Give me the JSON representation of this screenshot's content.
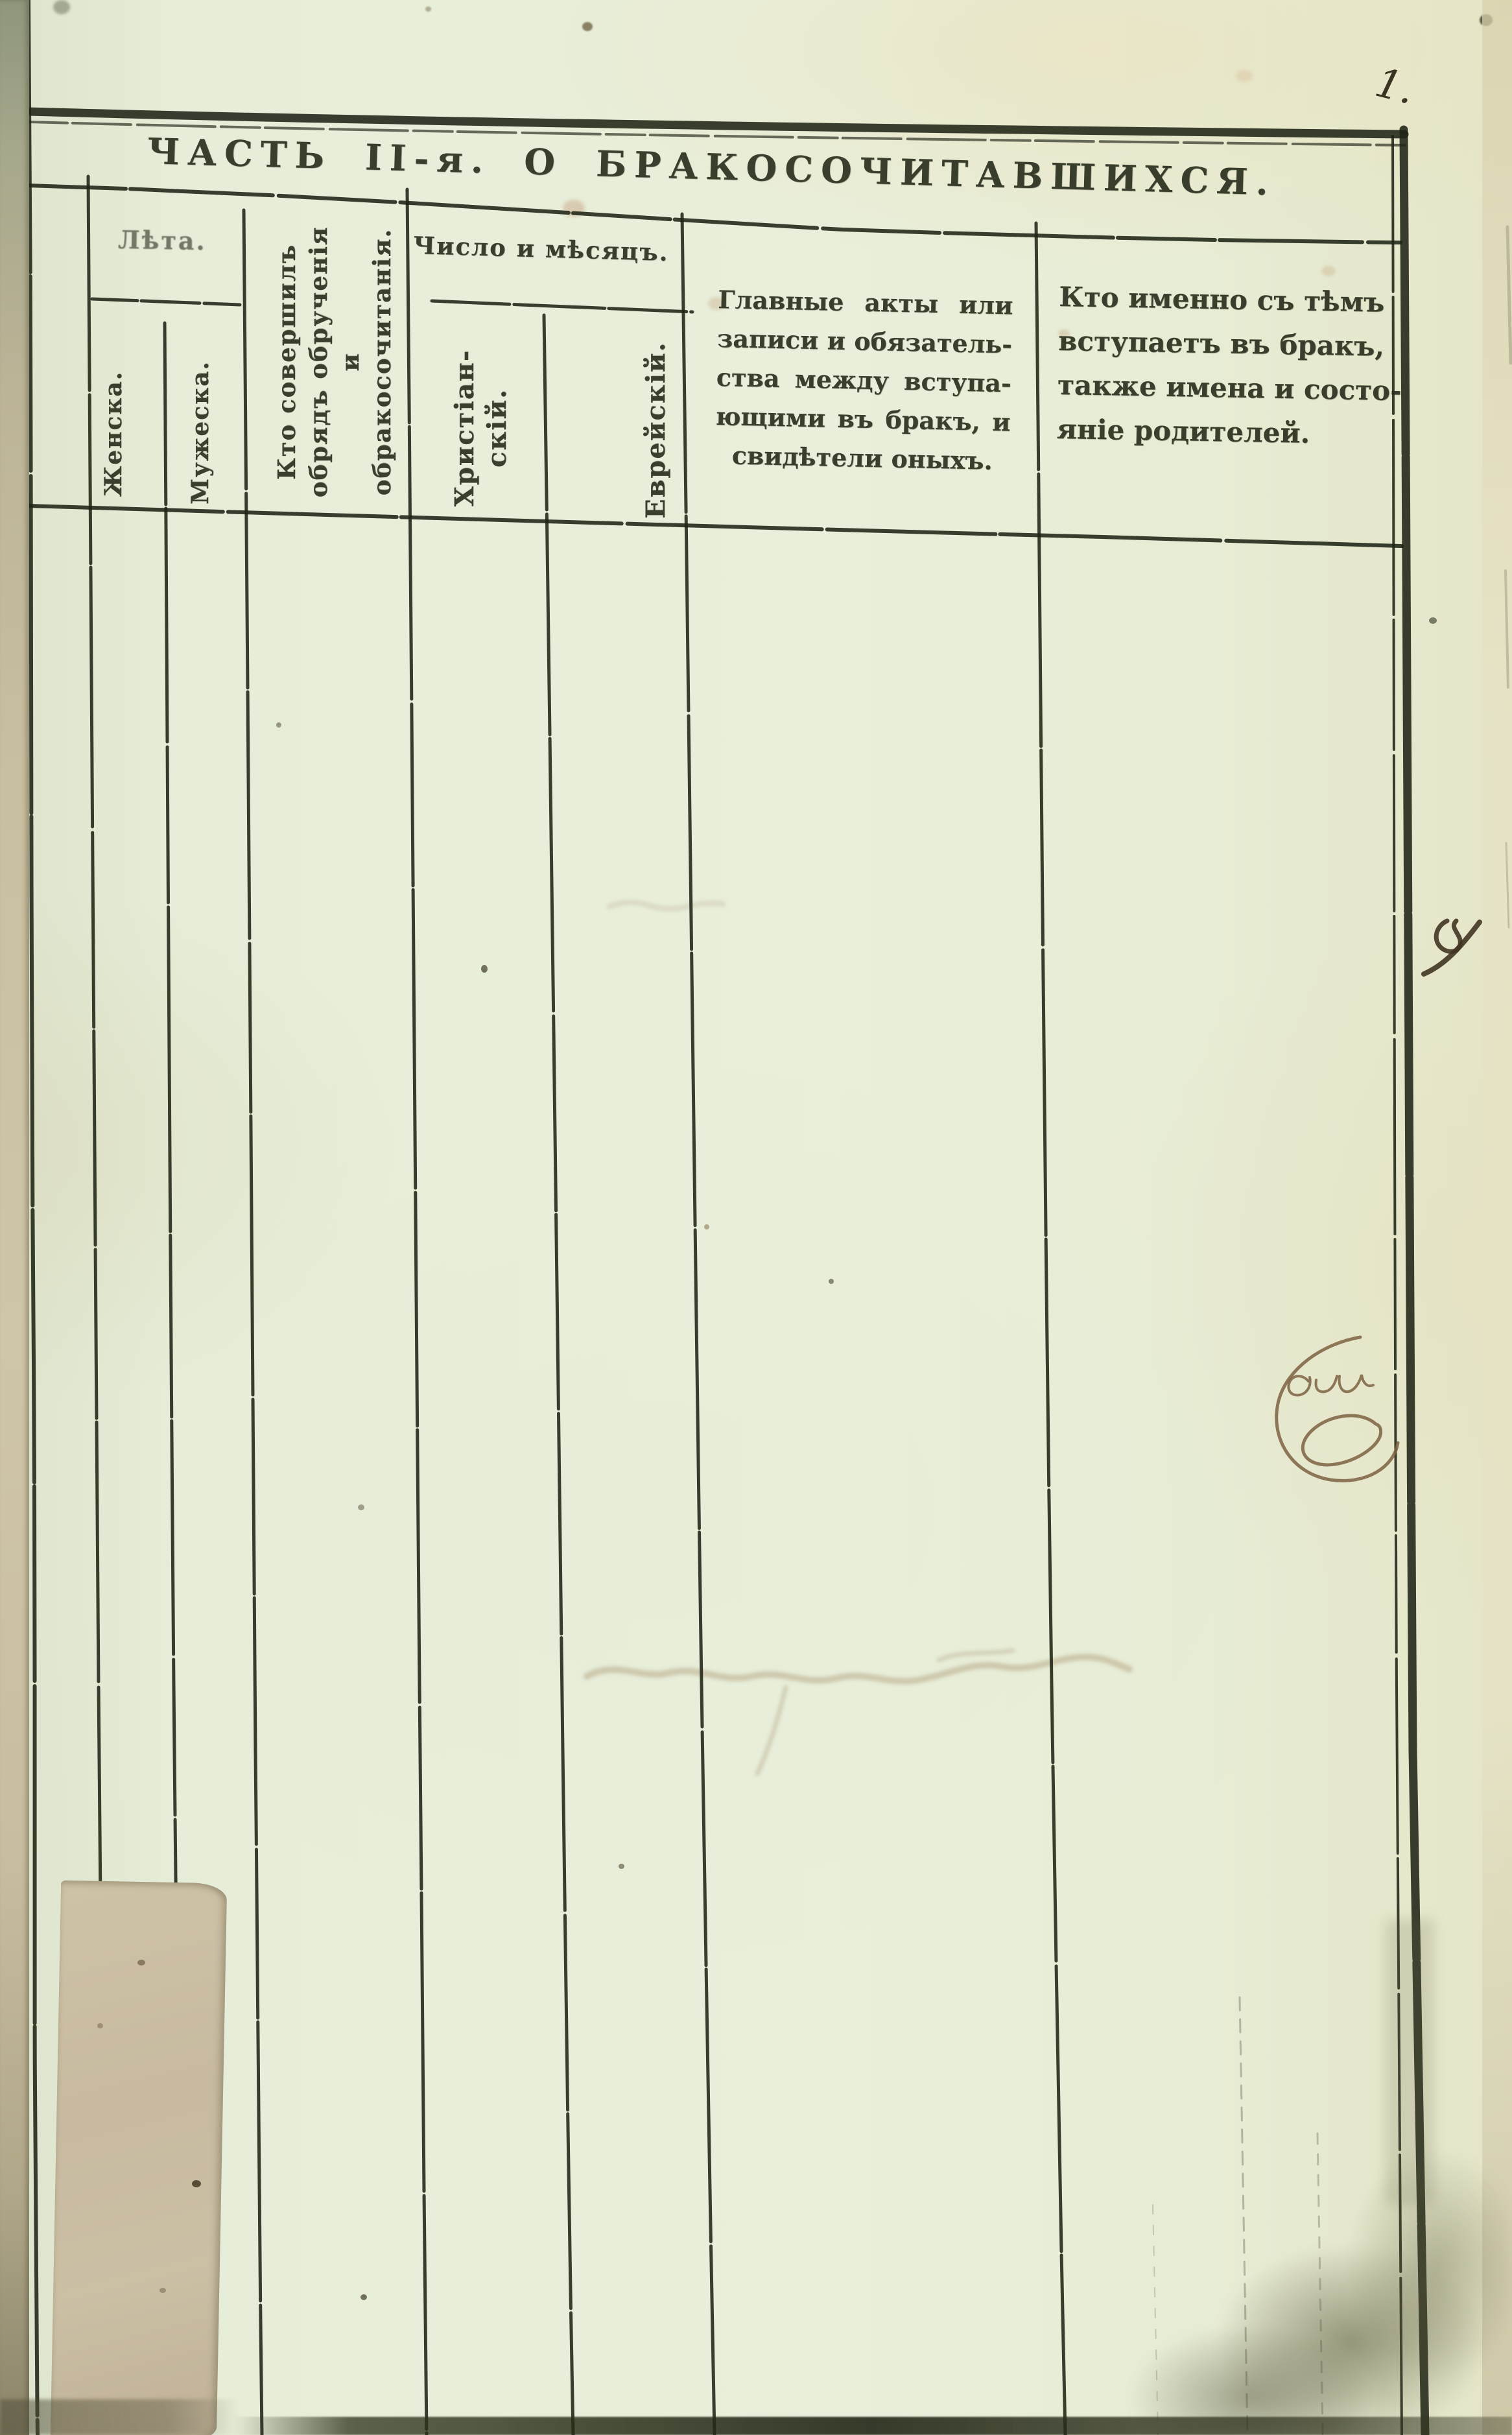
{
  "page": {
    "number": "1.",
    "title": "ЧАСТЬ II-я. О БРАКОСОЧИТАВШИХСЯ."
  },
  "table_header": {
    "age_group": {
      "label": "Лѣта.",
      "female": "Женска.",
      "male": "Мужеска."
    },
    "officiant": {
      "line1": "Кто совершилъ",
      "line2": "обрядъ обрученія",
      "line3": "и обракосочитанія."
    },
    "date_group": {
      "label": "Число и мѣсяцъ.",
      "christian_line1": "Христіан-",
      "christian_line2": "скій.",
      "jewish": "Еврейскій."
    },
    "acts": {
      "line1": "Главные акты или",
      "line2": "записи и обязатель-",
      "line3": "ства между вступа-",
      "line4": "ющими въ бракъ, и",
      "line5": "свидѣтели оныхъ."
    },
    "spouses": {
      "line1": "Кто именно съ тѣмъ",
      "line2": "вступаетъ въ бракъ,",
      "line3": "также имена и состо-",
      "line4": "яніе родителей."
    }
  },
  "handwritten": {
    "margin_mark": "х",
    "oval_note": "еи"
  },
  "colors": {
    "paper": "#e8eeda",
    "ink": "#272c1b",
    "stain_patch": "#c9bda2",
    "handwriting_brown": "#7d6142",
    "hand_ink_dark": "#3f3522"
  }
}
